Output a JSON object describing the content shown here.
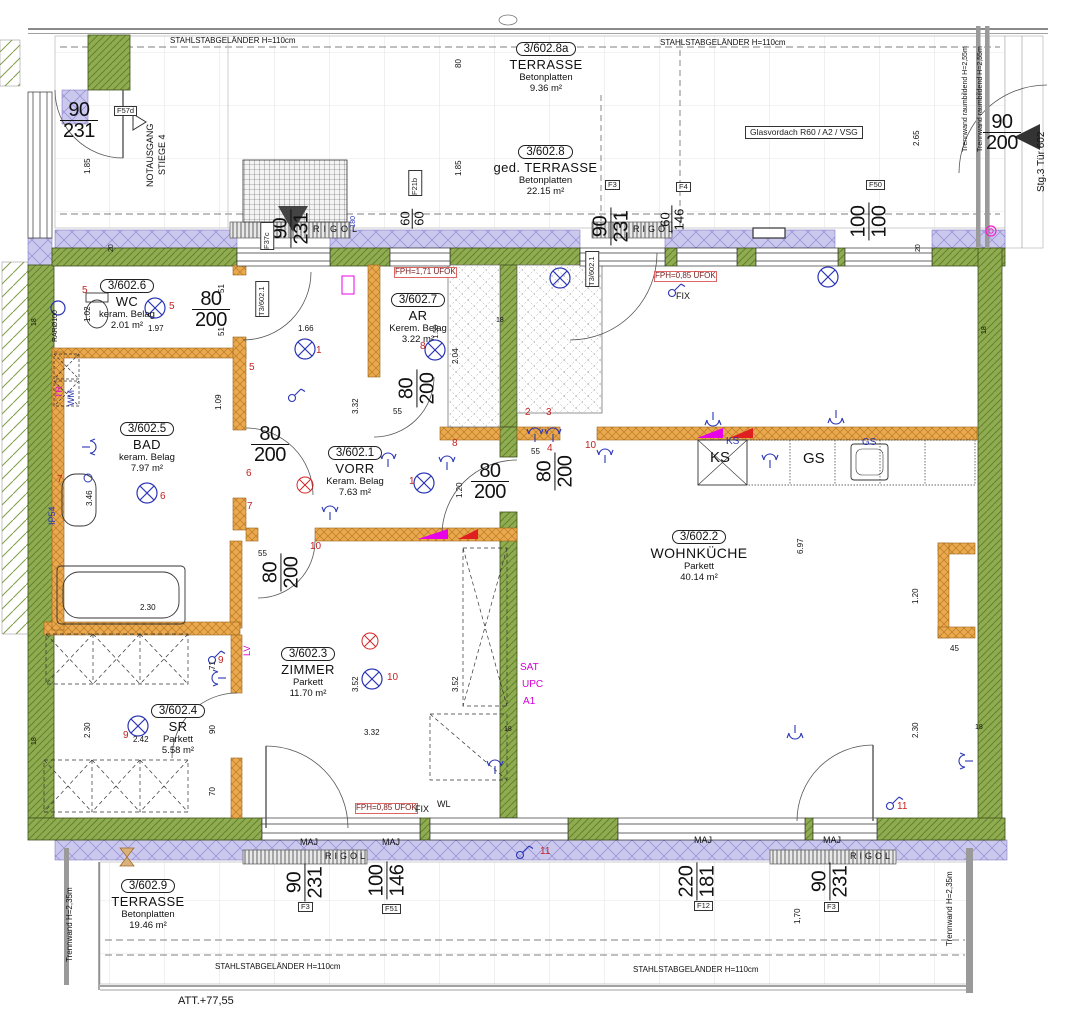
{
  "colors": {
    "wall_green": "#8fac50",
    "wall_orange": "#eba94f",
    "insulation": "#cbc8ee",
    "accent_red": "#c32222",
    "symbol_blue": "#2a35b5",
    "magenta": "#d400d4"
  },
  "rooms": {
    "t8a": {
      "id": "3/602.8a",
      "name": "TERRASSE",
      "floor": "Betonplatten",
      "area": "9.36 m²"
    },
    "t8": {
      "id": "3/602.8",
      "name": "ged. TERRASSE",
      "floor": "Betonplatten",
      "area": "22.15 m²"
    },
    "t9": {
      "id": "3/602.9",
      "name": "TERRASSE",
      "floor": "Betonplatten",
      "area": "19.46 m²"
    },
    "wc": {
      "id": "3/602.6",
      "name": "WC",
      "floor": "keram. Belag",
      "area": "2.01 m²"
    },
    "ar": {
      "id": "3/602.7",
      "name": "AR",
      "floor": "Kerem. Belag",
      "area": "3.22 m²"
    },
    "bad": {
      "id": "3/602.5",
      "name": "BAD",
      "floor": "keram. Belag",
      "area": "7.97 m²"
    },
    "vorr": {
      "id": "3/602.1",
      "name": "VORR",
      "floor": "Keram. Belag",
      "area": "7.63 m²"
    },
    "wk": {
      "id": "3/602.2",
      "name": "WOHNKÜCHE",
      "floor": "Parkett",
      "area": "40.14 m²"
    },
    "zi": {
      "id": "3/602.3",
      "name": "ZIMMER",
      "floor": "Parkett",
      "area": "11.70 m²"
    },
    "sr": {
      "id": "3/602.4",
      "name": "SR",
      "floor": "Parkett",
      "area": "5.58 m²"
    }
  },
  "t": {
    "railing": "STAHLSTABGELÄNDER H=110cm",
    "notausgang1": "NOTAUSGANG",
    "notausgang2": "STIEGE 4",
    "glasvordach": "Glasvordach R60 / A2 / VSG",
    "trennwand255": "Trennwand raumbildend H=2,55m",
    "trennwand235": "Trennwand H=2,35m",
    "stg": "Stg.3 Tür 602",
    "att": "ATT.+77,55",
    "rigol": "RIGOL",
    "maj": "MAJ",
    "fix": "FIX",
    "wl": "WL",
    "fph171": "FPH=1,71 ÜFOK",
    "fph085": "FPH=0,85 ÜFOK",
    "ks": "KS",
    "gs": "GS",
    "sat": "SAT",
    "upc": "UPC",
    "a1": "A1",
    "lv": "LV",
    "tr": "TR",
    "wm": "WM",
    "ip54": "IP54",
    "rar": "RARØ100",
    "n180": "180"
  },
  "tags": {
    "f57d": "F57d",
    "f37c": "F37c",
    "f21b": "F21b",
    "f3": "F3",
    "f4": "F4",
    "f50": "F50",
    "f51": "F51",
    "f12": "F12",
    "t3602": "T3/602.1"
  },
  "dims": {
    "w90": "90",
    "h231": "231",
    "h200": "200",
    "w80": "80",
    "w60": "60",
    "h60": "60",
    "h146": "146",
    "w100": "100",
    "h100": "100",
    "w220": "220",
    "h181": "181",
    "m185": "1.85",
    "m102": "1.02",
    "m197": "1.97",
    "m166": "1.66",
    "m109": "1.09",
    "m332": "3.32",
    "m352": "3.52",
    "m204": "2.04",
    "m55": "55",
    "m346": "3.46",
    "m230": "2.30",
    "m120": "1.20",
    "m242": "2.42",
    "m697": "6.97",
    "m265": "2.65",
    "m170": "1,70",
    "m45": "45",
    "m71": "71",
    "m90s": "90",
    "m70": "70",
    "m18": "18",
    "m20": "20",
    "m51": "51",
    "m158": "1.58",
    "m80": "80"
  },
  "circuits": {
    "n1": "1",
    "n2": "2",
    "n3": "3",
    "n4": "4",
    "n5": "5",
    "n6": "6",
    "n7": "7",
    "n8": "8",
    "n9": "9",
    "n10": "10",
    "n11": "11"
  }
}
